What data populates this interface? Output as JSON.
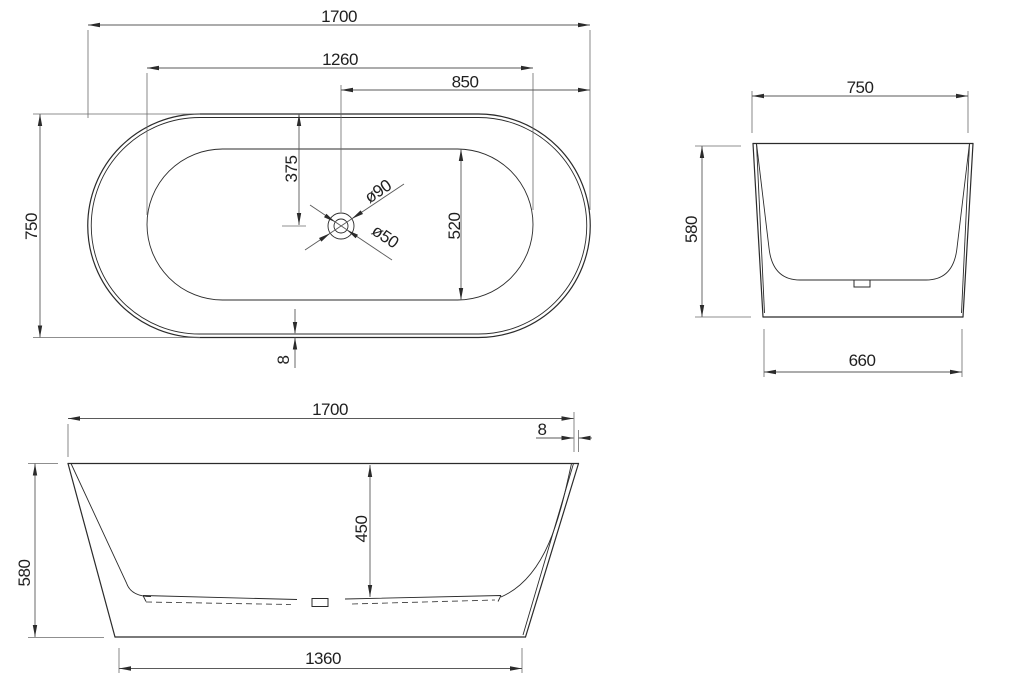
{
  "drawing_type": "bathtub-technical-drawing",
  "views": {
    "plan": {
      "overall_length": "1700",
      "basin_length": "1260",
      "drain_to_right_end": "850",
      "overall_width": "750",
      "drain_from_top_edge": "375",
      "basin_width": "520",
      "drain_outer_diameter": "ø90",
      "drain_hole_diameter": "ø50",
      "rim_thickness": "8"
    },
    "side": {
      "top_width": "750",
      "height": "580",
      "base_width": "660"
    },
    "front": {
      "top_length": "1700",
      "rim_thickness": "8",
      "height": "580",
      "inner_depth": "450",
      "base_length": "1360"
    }
  }
}
